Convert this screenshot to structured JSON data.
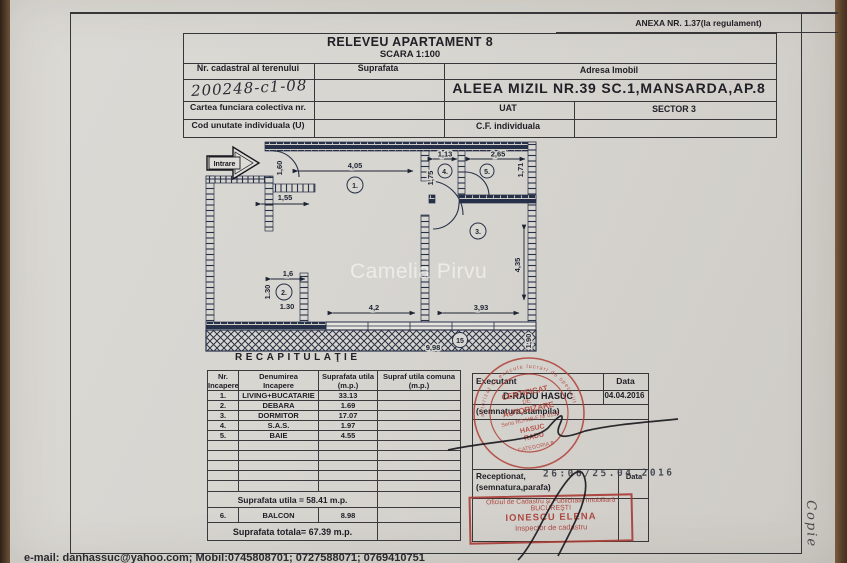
{
  "side": {
    "copy": "Copie"
  },
  "anexa": "ANEXA NR. 1.37(la regulament)",
  "header": {
    "title": "RELEVEU APARTAMENT 8",
    "scale": "SCARA 1:100",
    "nr_cadastral_label": "Nr. cadastral al terenului",
    "nr_cadastral_value": "200248-c1-08",
    "suprafata_label": "Suprafata",
    "adresa_label": "Adresa Imobil",
    "adresa_value": "ALEEA MIZIL NR.39 SC.1,MANSARDA,AP.8",
    "cartea_label": "Cartea funciara colectiva nr.",
    "uat_label": "UAT",
    "sector_value": "SECTOR 3",
    "cod_label": "Cod unutate individuala (U)",
    "cf_label": "C.F. individuala"
  },
  "plan": {
    "entrance_label": "Intrare",
    "watermark": "Camelia Pirvu",
    "room_numbers": {
      "living": "1.",
      "debara": "2.",
      "dormitor": "3.",
      "sas": "4.",
      "baie": "5.",
      "balcon": "15"
    },
    "dims": {
      "top_living": "4,05",
      "sas_w": "1,13",
      "baie_w": "2,65",
      "baie_h": "1,71",
      "sas_h": "1,75",
      "entry_h": "1,60",
      "hall": "1,55",
      "debara_w": "1,6",
      "debara_h": "1.30",
      "debara_h2": "1.30",
      "dormitor_h": "4,35",
      "living_bottom": "4,2",
      "dormitor_bottom": "3,93",
      "balcon_w": "9,98",
      "balcon_h": "1,90"
    }
  },
  "recap": {
    "title": "RECAPITULAŢIE",
    "col_headers": [
      [
        "Nr.",
        "Incapere"
      ],
      [
        "Denumirea",
        "Incapere"
      ],
      [
        "Suprafata utila",
        "(m.p.)"
      ],
      [
        "Supraf utila comuna",
        "(m.p.)"
      ]
    ],
    "rows": [
      {
        "nr": "1.",
        "name": "LIVING+BUCATARIE",
        "area": "33.13"
      },
      {
        "nr": "2.",
        "name": "DEBARA",
        "area": "1.69"
      },
      {
        "nr": "3.",
        "name": "DORMITOR",
        "area": "17.07"
      },
      {
        "nr": "4.",
        "name": "S.A.S.",
        "area": "1.97"
      },
      {
        "nr": "5.",
        "name": "BAIE",
        "area": "4.55"
      }
    ],
    "subtotal": "Suprafata utila = 58.41 m.p.",
    "balcon_row": {
      "nr": "6.",
      "name": "BALCON",
      "area": "8.98"
    },
    "total": "Suprafata totala= 67.39 m.p."
  },
  "executant": {
    "label": "Executant",
    "date_label": "Data",
    "name": "D-RADU HASUC",
    "date": "04.04.2016",
    "semnatura": "(semnatura,stampila)",
    "receptionat": "Receptionat,",
    "parafa": "(semnatura,parafa)",
    "date_label2": "Data",
    "date_stamp": "26:06/25.04.2016",
    "round_stamp": {
      "ring": "autorizat sa execute lucrari de specialitate",
      "l1": "CERTIFICAT",
      "l2": "DE",
      "l3": "AUTORIZARE",
      "l4": "Seria RO-MB-F Nr 0155",
      "l5": "HASUC",
      "l6": "RADU",
      "l7": "CATEGORIA B"
    },
    "office_stamp": {
      "l1": "Oficiul de Cadastru şi Publicitate Imobiliară",
      "l2": "BUCUREŞTI",
      "l3": "IONESCU ELENA",
      "l4": "Inspector de cadastru"
    }
  },
  "footer": {
    "contact": "e-mail: danhassuc@yahoo.com;  Mobil:0745808701;  0727588071;  0769410751"
  }
}
